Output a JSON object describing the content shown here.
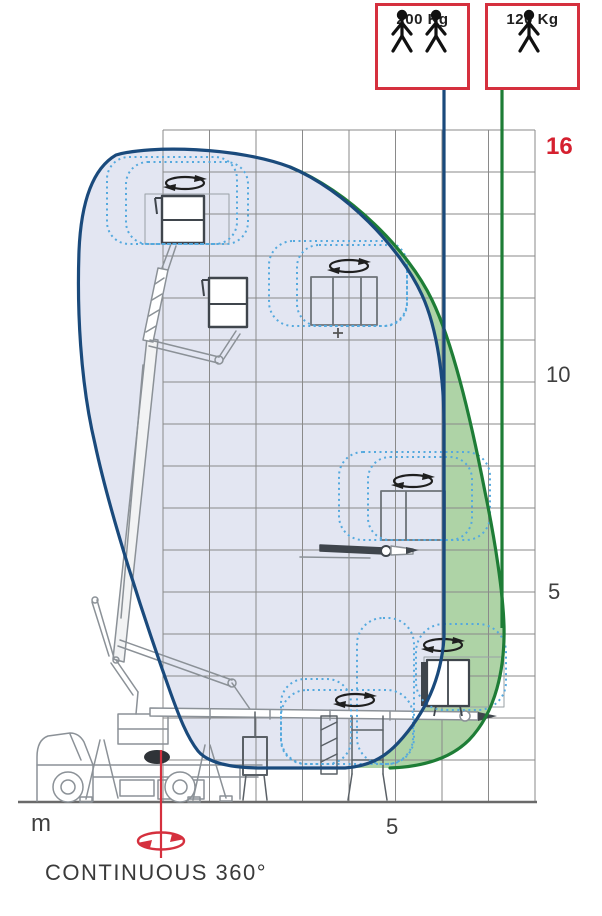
{
  "capacity_boxes": [
    {
      "label": "200 Kg",
      "persons": 2
    },
    {
      "label": "120 Kg",
      "persons": 1
    }
  ],
  "axis": {
    "y_max_label": "16",
    "y_tick_10": "10",
    "y_tick_5": "5",
    "x_tick_5": "5",
    "unit_label": "m"
  },
  "caption": "CONTINUOUS 360°",
  "colors": {
    "envelope_200kg_outline": "#1a4a7c",
    "envelope_200kg_fill": "#e3e6f2",
    "envelope_120kg_outline": "#1e7d36",
    "envelope_120kg_fill": "#aed3a6",
    "platform_ghost_dotted": "#55a9de",
    "grid": "#8a8a8a",
    "accent_red": "#d5303e",
    "text": "#3f3f3f"
  },
  "chart_data": {
    "type": "area",
    "title": "Aerial work platform working envelope",
    "x_unit": "m",
    "y_unit": "m",
    "x_range": [
      0,
      8
    ],
    "y_range": [
      0,
      16
    ],
    "grid_step_m": 1,
    "y_axis_tick_labels": [
      "16",
      "10",
      "5"
    ],
    "x_axis_tick_labels": [
      "5"
    ],
    "series": [
      {
        "name": "200 Kg",
        "persons": 2,
        "outline_color": "#1a4a7c",
        "max_height_m": 15.4,
        "max_outreach_m": 6.0,
        "outline_xy_m": [
          [
            -1.0,
            15.4
          ],
          [
            -1.8,
            13.1
          ],
          [
            -1.5,
            8.5
          ],
          [
            0.2,
            2.6
          ],
          [
            0.8,
            1.2
          ],
          [
            2.2,
            0.8
          ],
          [
            3.9,
            0.8
          ],
          [
            5.1,
            1.4
          ],
          [
            6.0,
            3.9
          ],
          [
            6.0,
            8.9
          ],
          [
            5.6,
            12.1
          ],
          [
            2.7,
            15.1
          ],
          [
            -1.0,
            15.4
          ]
        ]
      },
      {
        "name": "120 Kg",
        "persons": 1,
        "outline_color": "#1e7d36",
        "max_height_m": 15.1,
        "max_outreach_m": 7.3,
        "outline_xy_m": [
          [
            2.7,
            15.1
          ],
          [
            5.8,
            12.0
          ],
          [
            6.9,
            7.4
          ],
          [
            7.3,
            4.2
          ],
          [
            6.6,
            1.4
          ],
          [
            4.9,
            0.8
          ]
        ]
      }
    ],
    "annotations": [
      "CONTINUOUS 360°"
    ],
    "legend_position": "top-right boxes with person icons"
  }
}
